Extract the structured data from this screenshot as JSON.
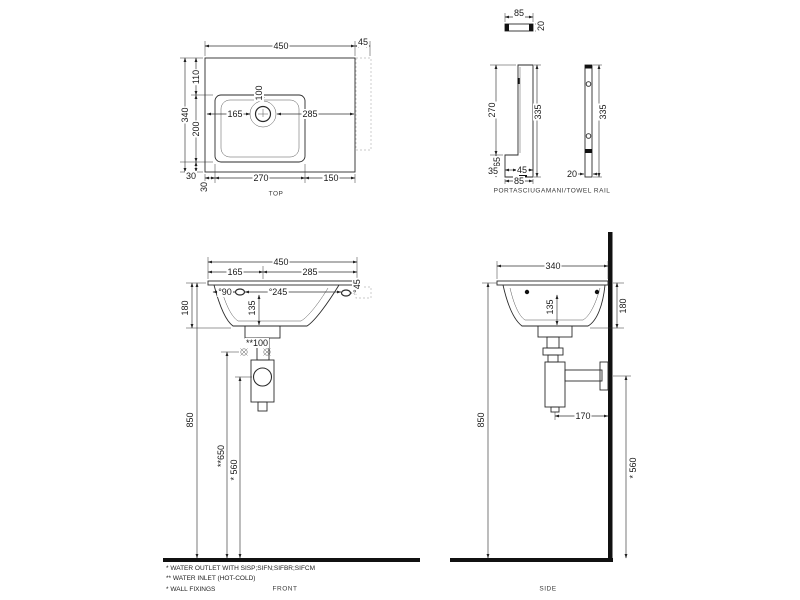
{
  "top_view": {
    "label": "TOP",
    "d450": "450",
    "d45": "45",
    "d110": "110",
    "d200": "200",
    "d340": "340",
    "d30_left": "30",
    "d30_bottom": "30",
    "d270": "270",
    "d150": "150",
    "d165": "165",
    "d285": "285",
    "d100": "100"
  },
  "rail_view": {
    "label": "PORTASCIUGAMANI/TOWEL RAIL",
    "d85_plan": "85",
    "d20_plan": "20",
    "d270": "270",
    "d335_front": "335",
    "d65": "65",
    "d35": "35",
    "d45": "45",
    "d85_bottom": "85",
    "d335_side": "335",
    "d20_side": "20"
  },
  "front_view": {
    "label": "FRONT",
    "d450": "450",
    "d165": "165",
    "d285": "285",
    "d90": "°90",
    "d245": "°245",
    "d45": "°45",
    "d180": "180",
    "d135": "135",
    "d100": "**100",
    "d850": "850",
    "d650": "**650",
    "d560": "* 560"
  },
  "side_view": {
    "label": "SIDE",
    "d340": "340",
    "d135": "135",
    "d180": "180",
    "d170": "170",
    "d850": "850",
    "d560": "* 560"
  },
  "notes": {
    "outlet": "* WATER OUTLET WITH SISP;SIFN;SIFBR;SIFCM",
    "inlet": "** WATER INLET  (HOT-COLD)",
    "fixings": "* WALL FIXINGS"
  }
}
